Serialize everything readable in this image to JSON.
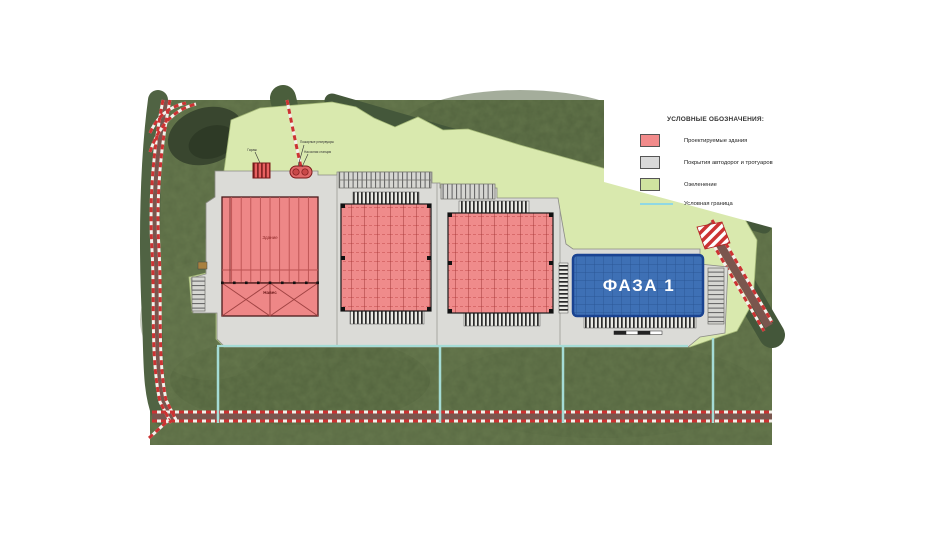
{
  "legend": {
    "title": "УСЛОВНЫЕ ОБОЗНАЧЕНИЯ:",
    "items": [
      {
        "id": "buildings",
        "label": "Проектируемые здания",
        "swatch": "#f28b8b"
      },
      {
        "id": "pavement",
        "label": "Покрытия автодорог и тротуаров",
        "swatch": "#d9d9d9"
      },
      {
        "id": "greenery",
        "label": "Озеленение",
        "swatch": "#cfe3a0"
      },
      {
        "id": "boundary",
        "label": "Условная граница",
        "swatch": "#8fd8e4"
      }
    ]
  },
  "plan": {
    "phase_label": "ФАЗА 1",
    "labels": {
      "warehouse": "Здание",
      "canopy": "Навес",
      "garage": "Гараж",
      "fire_tanks": "Пожарные резервуары",
      "pump_station": "Насосная станция"
    }
  },
  "colors": {
    "building_fill": "#ef8b8b",
    "building_outline": "#5a1f1f",
    "phase_building_fill": "#3e70b5",
    "phase_building_outline": "#1a4391",
    "pavement": "#dbdbd7",
    "greenery": "#d9e9ae",
    "boundary_line": "#a5dcd6",
    "road_marking": "#cc3333",
    "grass": "#5a6b44"
  }
}
